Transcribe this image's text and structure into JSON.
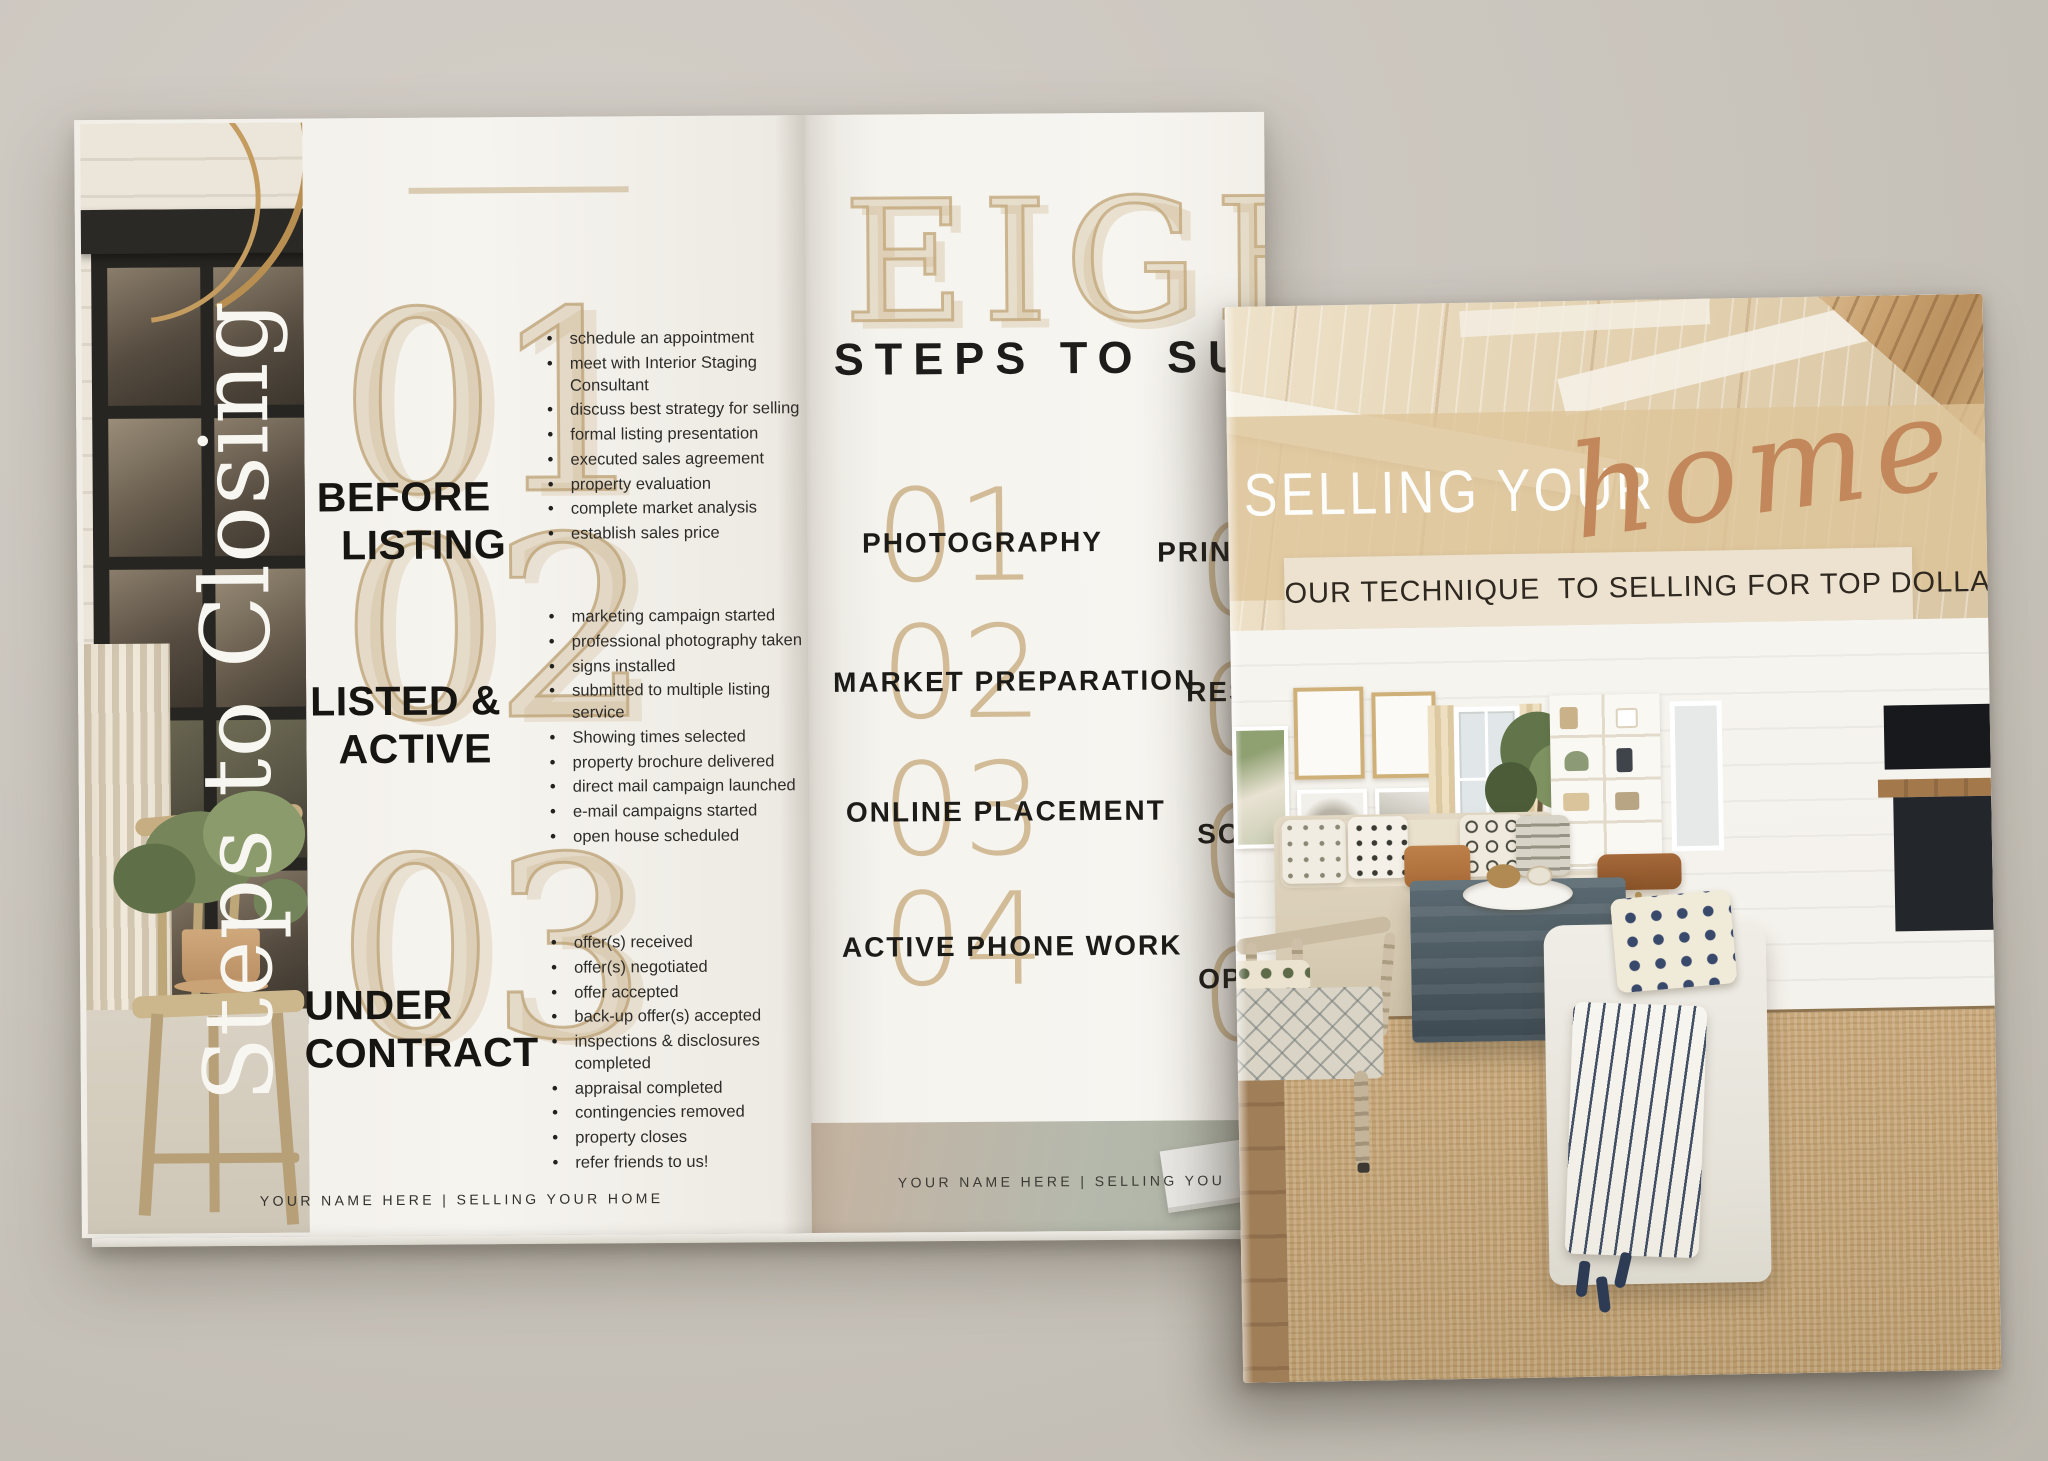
{
  "colors": {
    "background": "#c9c4bc",
    "page": "#f4f2ed",
    "accent_tan": "#d3bd97",
    "accent_copper": "#c2875a",
    "ink_black": "#1d1b18",
    "ottoman_slate": "#4f5c64",
    "navy": "#2e3d55"
  },
  "left_page": {
    "vertical_title": "Steps to Closing",
    "footer": "YOUR NAME HERE | SELLING YOUR HOME",
    "sections": [
      {
        "number": "01",
        "title_line1": "BEFORE",
        "title_line2": "LISTING",
        "items": [
          "schedule an appointment",
          "meet with Interior Staging Consultant",
          "discuss best strategy for selling",
          "formal listing presentation",
          "executed sales agreement",
          "property evaluation",
          "complete market analysis",
          "establish sales price"
        ]
      },
      {
        "number": "02",
        "title_line1": "LISTED &",
        "title_line2": "ACTIVE",
        "items": [
          "marketing campaign started",
          "professional photography taken",
          "signs installed",
          "submitted to multiple listing service",
          "Showing times selected",
          "property brochure delivered",
          "direct mail campaign launched",
          "e-mail campaigns started",
          "open house scheduled"
        ]
      },
      {
        "number": "03",
        "title_line1": "UNDER",
        "title_line2": "CONTRACT",
        "items": [
          "offer(s) received",
          "offer(s) negotiated",
          "offer accepted",
          "back-up offer(s) accepted",
          "inspections & disclosures completed",
          "appraisal completed",
          "contingencies removed",
          "property closes",
          "refer friends to us!"
        ]
      }
    ]
  },
  "middle_page": {
    "headline": "EIGHT",
    "subheadline": "STEPS TO SU",
    "steps": [
      {
        "number": "01",
        "label": "PHOTOGRAPHY"
      },
      {
        "number": "02",
        "label": "MARKET PREPARATION"
      },
      {
        "number": "03",
        "label": "ONLINE PLACEMENT"
      },
      {
        "number": "04",
        "label": "ACTIVE PHONE WORK"
      }
    ],
    "steps_right_partial": [
      {
        "number": "0",
        "label": "PRIN"
      },
      {
        "number": "0",
        "label": "RES"
      },
      {
        "number": "0",
        "label": "SO"
      },
      {
        "number": "0",
        "label": "OP"
      }
    ],
    "footer": "YOUR NAME HERE | SELLING YOU"
  },
  "cover": {
    "title_main": "SELLING YOUR",
    "title_script": "home",
    "tagline": "OUR TECHNIQUE  TO SELLING FOR TOP DOLLAR"
  }
}
